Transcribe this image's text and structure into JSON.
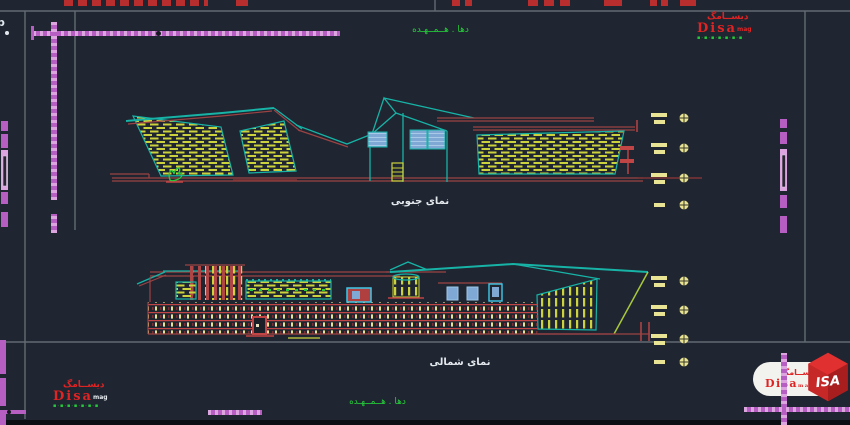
{
  "colors": {
    "bg": "#1f2531",
    "frame": "#636a72",
    "teal": "#17b3a6",
    "yellow": "#ccd23c",
    "paleyellow": "#e9e493",
    "red": "#9c4343",
    "redbright": "#c24545",
    "reddark": "#7e3535",
    "magenta": "#b75ec2",
    "magentalight": "#dca5df",
    "green": "#25cb3a",
    "blue": "#7fa8d4",
    "bluelight": "#a9c9e8",
    "white": "#e4e9ee",
    "logored": "#e02323",
    "lime": "#a9c93a",
    "black": "#0b0e12"
  },
  "titles": {
    "top": "دها . هــمــهـده",
    "bottom": "دها . هــمــهـده"
  },
  "elevations": {
    "south_label": "نمای جنوبی",
    "north_label": "نمای شمالی"
  },
  "logos": {
    "top_right": {
      "persian": "دیســامگ",
      "latin": "Disa",
      "suffix": "mag",
      "row": "▪·▪·▪·▪·▪·▪·▪"
    },
    "bottom_left": {
      "persian": "دیســامگ",
      "latin": "Disa",
      "suffix": "mag",
      "row": "▪·▪·▪·▪·▪·▪·▪"
    },
    "badge": {
      "persian": "دیســامگ",
      "latin": "Disa",
      "suffix": "mag",
      "cube": "ISA"
    }
  },
  "level_markers": {
    "top_group": 4,
    "bottom_group": 4
  },
  "stray": {
    "glyph": "p"
  }
}
